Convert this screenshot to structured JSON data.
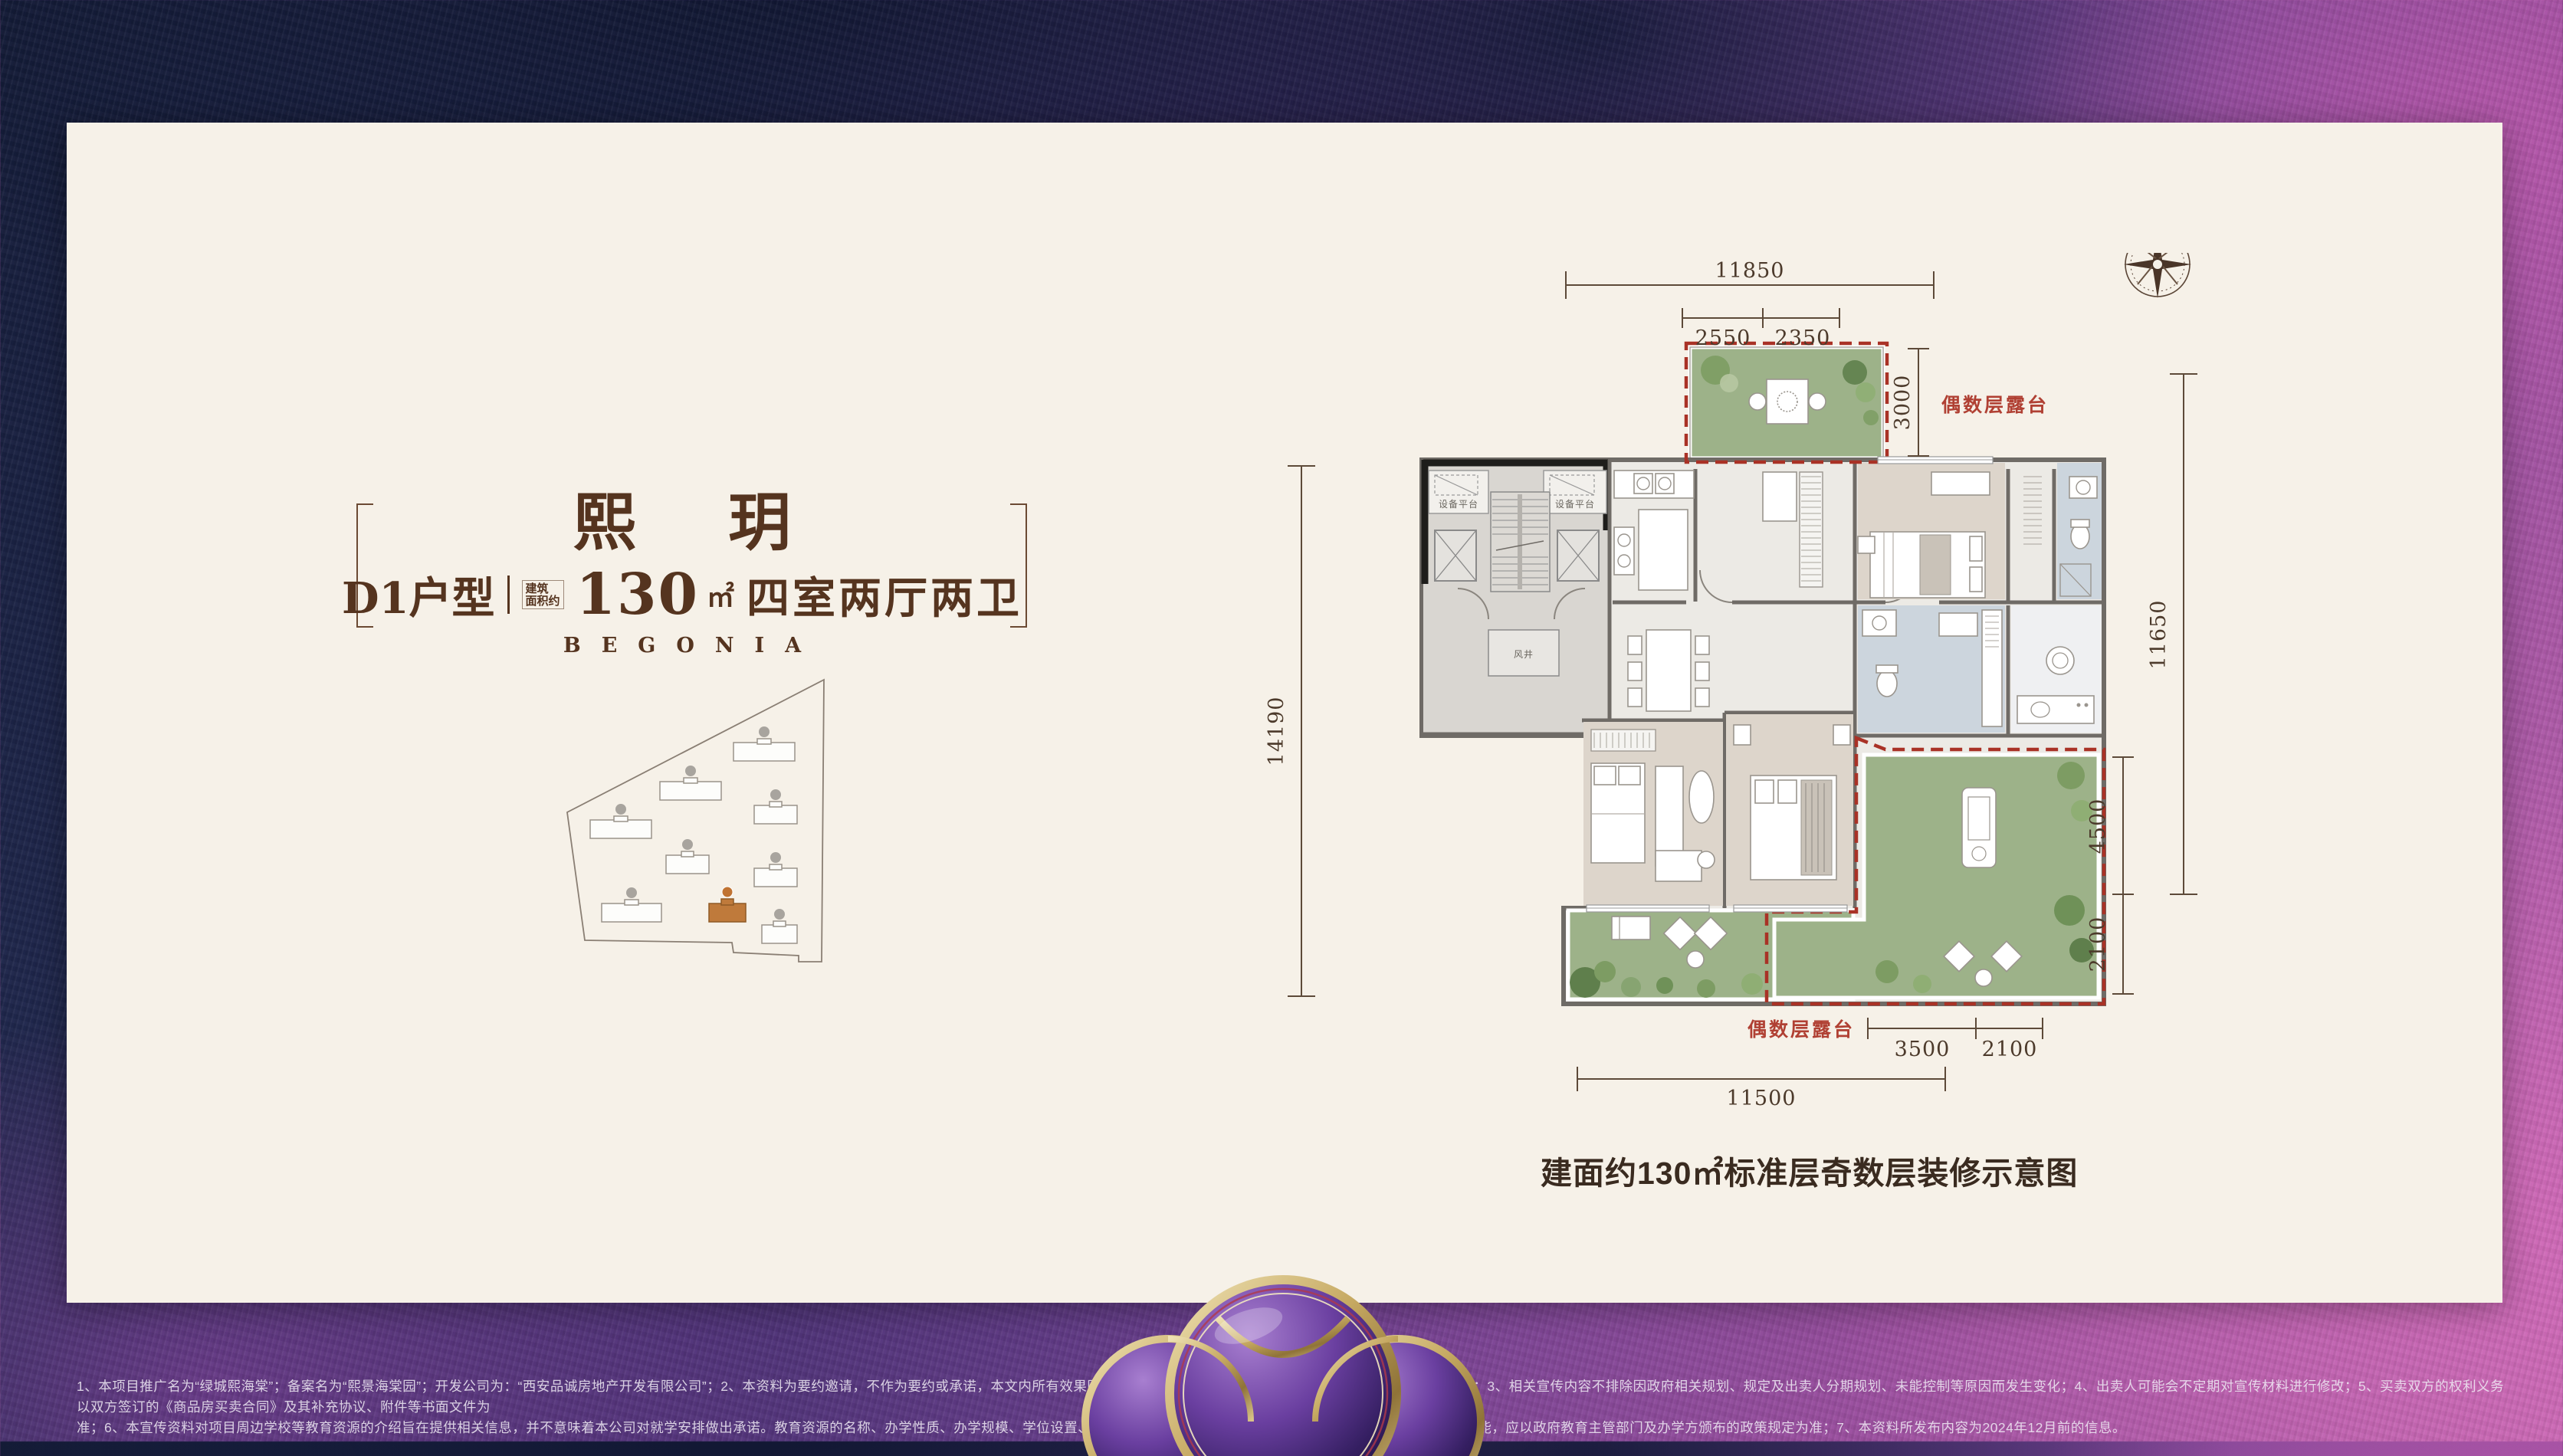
{
  "header": {
    "title": "熙 玥",
    "unit_label": "D1户型",
    "area_note_line1": "建筑",
    "area_note_line2": "面积约",
    "area_value": "130",
    "area_unit": "㎡",
    "rooms_label": "四室两厅两卫",
    "brand_en": "BEGONIA",
    "accent_brown": "#55341f"
  },
  "site_plan": {
    "highlight_color": "#bf7a3b",
    "building_count": 9
  },
  "floor_plan": {
    "accent_red": "#a93226",
    "terrace_green": "#9db289",
    "dims": {
      "top_overall": "11850",
      "top_seg1": "2550",
      "top_seg2": "2350",
      "terrace_height": "3000",
      "left_overall": "14190",
      "right_overall": "11650",
      "right_seg1": "4500",
      "right_seg2": "2100",
      "bottom_seg1": "3500",
      "bottom_seg2": "2100",
      "bottom_overall": "11500"
    },
    "labels": {
      "terrace_even_top": "偶数层露台",
      "terrace_even_bottom": "偶数层露台",
      "equip_platform": "设备平台",
      "wind_shaft": "风井",
      "north": "N"
    }
  },
  "caption": "建面约130㎡标准层奇数层装修示意图",
  "disclaimer": {
    "line1": "1、本项目推广名为“绿城熙海棠”；备案名为“熙景海棠园”；开发公司为：“西安品诚房地产开发有限公司”；2、本资料为要约邀请，不作为要约或承诺，本文内所有效果图均为示意，最终交付请以《商品房买卖合同》及实际交付为准；3、相关宣传内容不排除因政府相关规划、规定及出卖人分期规划、未能控制等原因而发生变化；4、出卖人可能会不定期对宣传材料进行修改；5、买卖双方的权利义务以双方签订的《商品房买卖合同》及其补充协议、附件等书面文件为",
    "line2": "准；6、本宣传资料对项目周边学校等教育资源的介绍旨在提供相关信息，并不意味着本公司对就学安排做出承诺。教育资源的名称、办学性质、办学规模、学位设置、开学（班）时间、招生条件、收费标准及招生区域存在调整的可能，应以政府教育主管部门及办学方颁布的政策规定为准；7、本资料所发布内容为2024年12月前的信息。"
  }
}
